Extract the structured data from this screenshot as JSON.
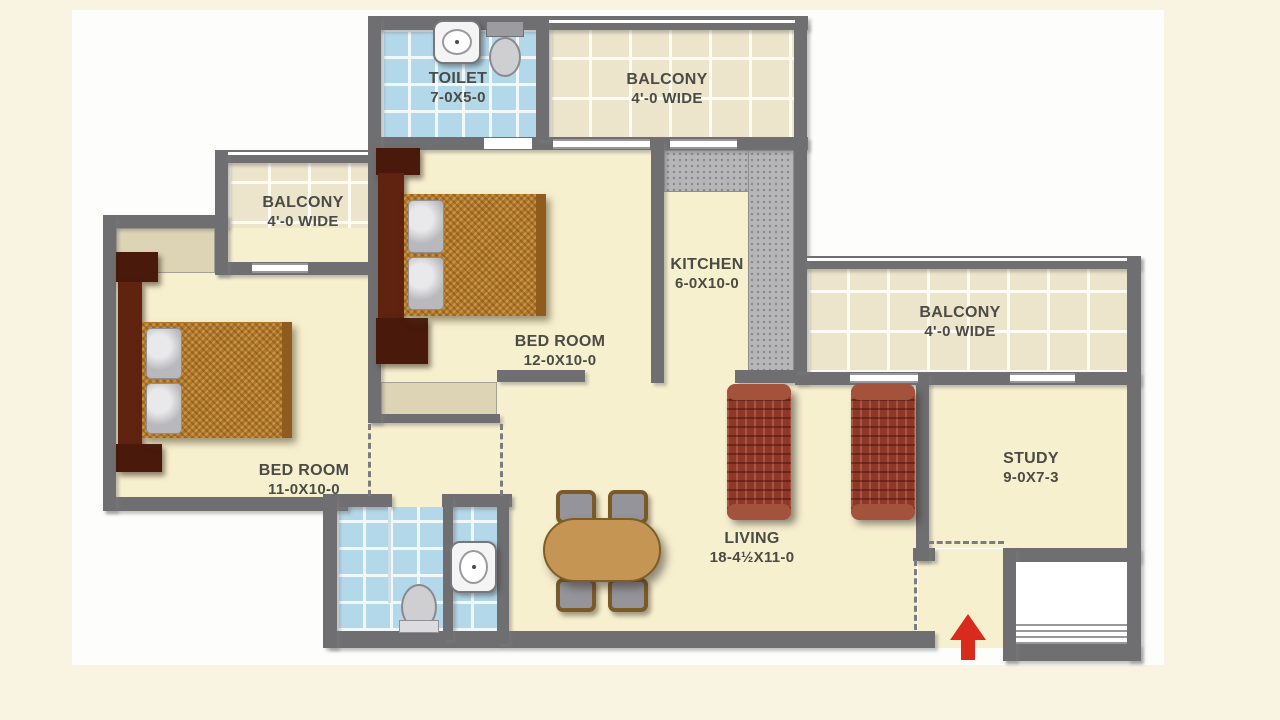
{
  "plan": {
    "rooms": {
      "toilet_top": {
        "name": "TOILET",
        "dims": "7-0X5-0"
      },
      "balcony_top": {
        "name": "BALCONY",
        "dims": "4'-0 WIDE"
      },
      "balcony_left": {
        "name": "BALCONY",
        "dims": "4'-0 WIDE"
      },
      "bedroom_middle": {
        "name": "BED ROOM",
        "dims": "12-0X10-0"
      },
      "kitchen": {
        "name": "KITCHEN",
        "dims": "6-0X10-0"
      },
      "balcony_right": {
        "name": "BALCONY",
        "dims": "4'-0 WIDE"
      },
      "bedroom_left": {
        "name": "BED ROOM",
        "dims": "11-0X10-0"
      },
      "living": {
        "name": "LIVING",
        "dims": "18-4½X11-0"
      },
      "study": {
        "name": "STUDY",
        "dims": "9-0X7-3"
      }
    },
    "colors": {
      "page_bg": "#f9f4e1",
      "board_bg": "#fdfdfc",
      "wall": "#6f6f71",
      "floor": "#f7f0cf",
      "tile_cream": "#ece4cb",
      "tile_blue": "#b2d8ea",
      "counter_gray": "#b6b6b8",
      "wardrobe_niche": "#dcd4b4",
      "label_text": "#4b4b45",
      "entry_arrow_red": "#da2a1e"
    }
  }
}
